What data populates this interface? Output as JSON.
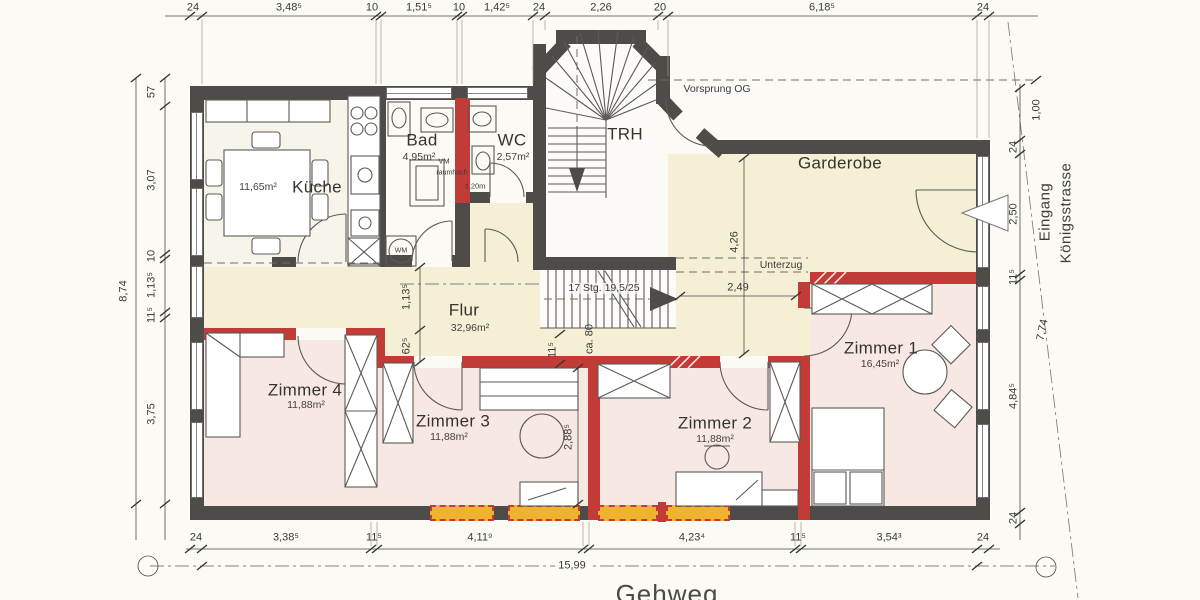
{
  "rooms": {
    "kueche": {
      "name": "Küche",
      "area": "11,65m²"
    },
    "bad": {
      "name": "Bad",
      "area": "4,95m²"
    },
    "wc": {
      "name": "WC",
      "area": "2,57m²"
    },
    "trh": {
      "name": "TRH"
    },
    "garderobe": {
      "name": "Garderobe"
    },
    "flur": {
      "name": "Flur",
      "area": "32,96m²"
    },
    "zimmer1": {
      "name": "Zimmer 1",
      "area": "16,45m²"
    },
    "zimmer2": {
      "name": "Zimmer 2",
      "area": "11,88m²"
    },
    "zimmer3": {
      "name": "Zimmer 3",
      "area": "11,88m²"
    },
    "zimmer4": {
      "name": "Zimmer 4",
      "area": "11,88m²"
    }
  },
  "annotations": {
    "vorsprung_og": "Vorsprung OG",
    "unterzug": "Unterzug",
    "stairs_spec": "17 Stg. 19,5/25",
    "wm": "WM",
    "vm": "VM",
    "vm_note": "raumhoch",
    "vm_height": "1,20m",
    "eingang": "Eingang",
    "street": "Königsstrasse",
    "gehweg": "Gehweg"
  },
  "dims": {
    "top": [
      "24",
      "3,48⁵",
      "10",
      "1,51⁵",
      "10",
      "1,42⁵",
      "24",
      "2,26",
      "20",
      "6,18⁵",
      "24"
    ],
    "left": [
      "57",
      "3,07",
      "10",
      "1,13⁵",
      "11⁵",
      "3,75",
      "8,74"
    ],
    "right": [
      "1,00",
      "24",
      "2,50",
      "11⁵",
      "4,84⁵",
      "24",
      "7,74"
    ],
    "bottom": [
      "24",
      "3,38⁵",
      "11⁵",
      "4,11⁹",
      "4,23⁴",
      "11⁵",
      "3,54³",
      "24",
      "15,99"
    ],
    "inner": {
      "flur_left_height": "1,13⁵",
      "passage_62": "62⁵",
      "passage_11": "11⁵",
      "passage_ca80": "ca. 80",
      "zimmer3_height": "2,88⁵",
      "garderobe_height": "4,26",
      "garderobe_width": "2,49"
    }
  },
  "colors": {
    "wall_existing": "#4e4c49",
    "wall_new_red": "#c33b37",
    "zone_rooms_pink": "#f7e8e3",
    "zone_hall_cream": "#f5efd5",
    "window_marker_yellow": "#efb32f",
    "paper": "#fbfaf5"
  }
}
